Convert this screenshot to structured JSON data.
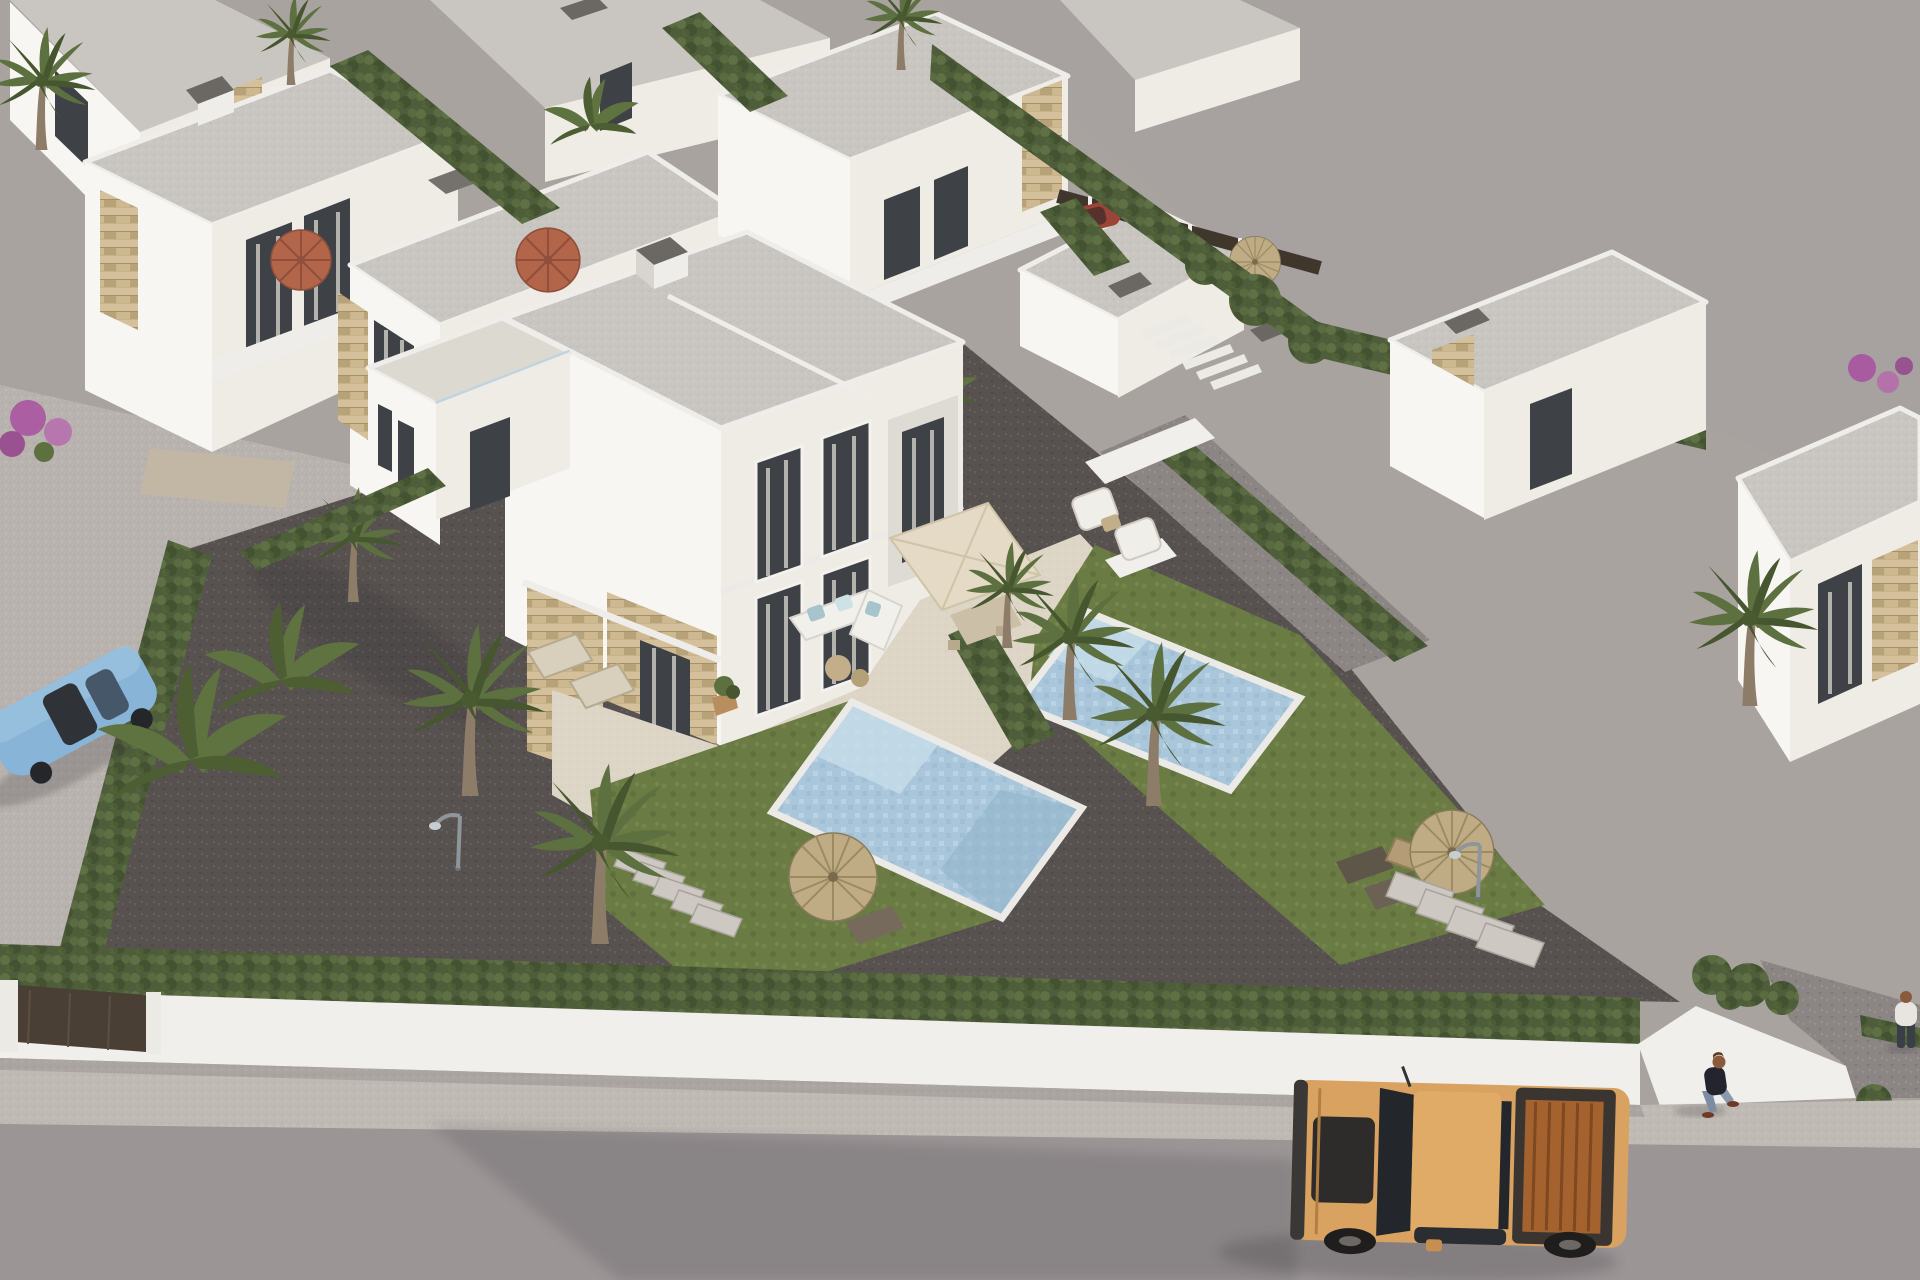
{
  "scene": {
    "description": "Aerial 3D architectural rendering of a modern Mediterranean villa development: white flat-roofed twin villas with sandstone cladding, private pools with lawns, palm trees and cypress hedges inside a white perimeter wall, a vacant grey plot behind the boundary hedge, and a street in front where a tan pickup truck drives past while a pedestrian walks on the pavement.",
    "objects": {
      "background_villas": {
        "label": "Rows of white flat-roofed villas with hedges, parasols, roof stairs and palm trees"
      },
      "vacant_lot": {
        "label": "Empty grey building plot behind the boundary hedge and dark fence"
      },
      "main_villa": {
        "label": "Two-storey twin villa with tiled roof terrace, sandstone cladding and curtained windows"
      },
      "terrace": {
        "label": "Cream-tiled terrace with white lounge sofa, square dining parasol and armchairs"
      },
      "left_pool": {
        "label": "Mosaic swimming pool with entry steps, left garden"
      },
      "right_pool": {
        "label": "Mosaic swimming pool with entry steps, right garden"
      },
      "left_garden": {
        "label": "Dark gravel garden with fan palms, straw parasol, lamp post and stepping stones"
      },
      "right_garden": {
        "label": "Lawn garden with straw parasol, wooden picnic table, loungers and stepping stones"
      },
      "neighbor_right": {
        "label": "Single-storey neighbour villa with stone accent and gravel driveway"
      },
      "perimeter": {
        "label": "White boundary wall topped by a clipped hedge, bronze entrance gates and white driveway apron"
      },
      "street": {
        "label": "Grey asphalt street with speckled concrete pavement"
      },
      "pickup_truck": {
        "label": "Tan pickup truck with open copper cargo bed driving along the street"
      },
      "blue_car": {
        "label": "Light-blue saloon car parked beside banana palms"
      },
      "red_car": {
        "label": "Small red car parked behind the rear fence"
      },
      "pedestrian": {
        "label": "Pedestrian in a dark top and jeans walking on the pavement"
      },
      "second_person": {
        "label": "Person in a white top standing on the right driveway"
      }
    }
  },
  "palette": {
    "bare_lot": "#a7a1a0",
    "estate": "#a9a3a0",
    "street_concrete": "#b8b3ae",
    "road": "#9b9596",
    "sidewalk": "#bfbab4",
    "wall_white": "#f1efeb",
    "f_sun": "#f8f6f2",
    "f_sh": "#efece6",
    "f_dk": "#d5d2cc",
    "roof": "#c9c6c1",
    "roof_edge": "#efede9",
    "tile": "#dcd9d1",
    "terrace": "#ddd5c6",
    "glass": "#3e4247",
    "curtain": "#c9c5be",
    "pool": "#a9c6da",
    "pool_steps": "#c6dce9",
    "coping": "#eceae6",
    "straw": "#bfac85",
    "terra": "#b26549",
    "canvas": "#e4dac5",
    "truck": "#d9a260",
    "truck_bed": "#a4622f",
    "car_blue": "#88b4d8",
    "gate": "#4a3f34",
    "trunk": "#8d7d68",
    "purple": "#a84fa0",
    "hedge_green": "#4e5e3a",
    "hedge_light": "#6d7f4c",
    "lawn_green": "#6a7b43",
    "gravel_dark": "#575250",
    "gravel_mid": "#8b8684",
    "stone_cladding": "#c6b28c"
  }
}
